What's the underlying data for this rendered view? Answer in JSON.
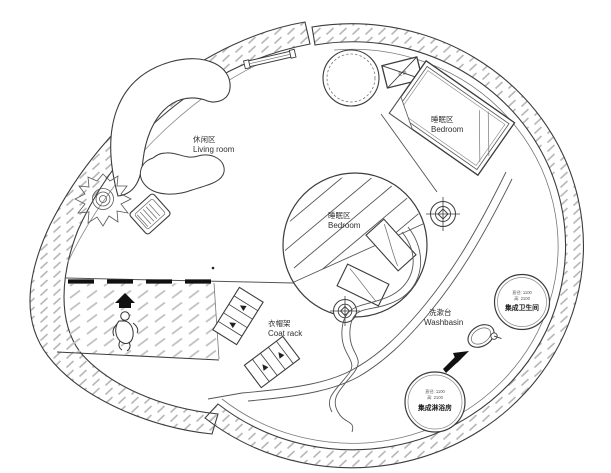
{
  "canvas": {
    "width": 611,
    "height": 473
  },
  "colors": {
    "background": "#ffffff",
    "line": "#3c3c3c",
    "wall_hatch": "#b8b8b8",
    "text": "#2f2f2f"
  },
  "zones": {
    "living_room": {
      "label_zh": "休闲区",
      "label_en": "Living room"
    },
    "bedroom_upper": {
      "label_zh": "睡眠区",
      "label_en": "Bedroom"
    },
    "bedroom_center": {
      "label_zh": "睡眠区",
      "label_en": "Bedroom"
    },
    "coat_rack": {
      "label_zh": "衣帽架",
      "label_en": "Coat rack"
    },
    "washbasin": {
      "label_zh": "洗漱台",
      "label_en": "Washbasin"
    }
  },
  "pods": {
    "bathroom": {
      "spec_diameter": "直径: 1100",
      "spec_height": "高: 2100",
      "name": "集成卫生间"
    },
    "shower": {
      "spec_diameter": "直径: 1100",
      "spec_height": "高: 2100",
      "name": "集成淋浴房"
    }
  },
  "equipment": {
    "ac_label": "空调"
  }
}
